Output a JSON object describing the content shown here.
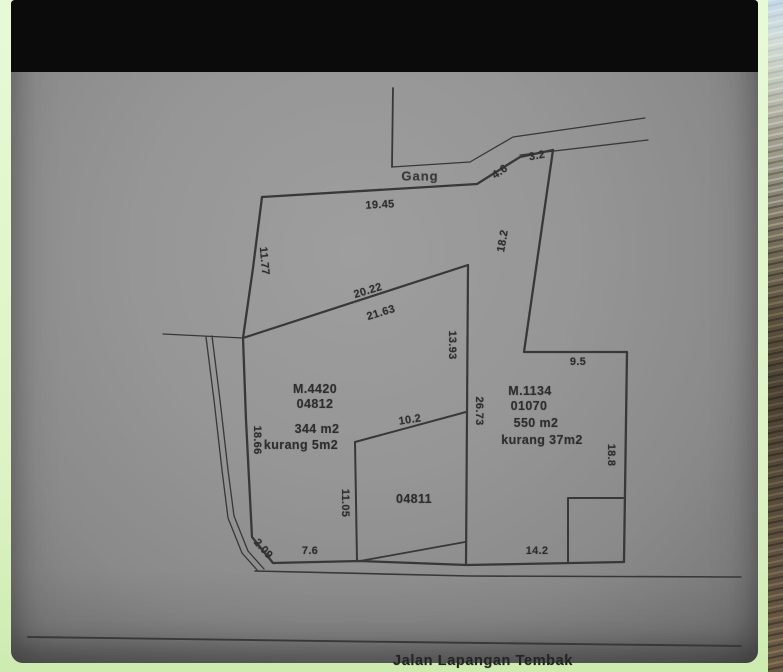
{
  "map": {
    "top_path_label": "Gang",
    "bottom_road_label": "Jalan Lapangan Tembak",
    "parcels": {
      "left": {
        "cert": "M.4420",
        "number": "04812",
        "area": "344 m2",
        "shortage": "kurang 5m2"
      },
      "right": {
        "cert": "M.1134",
        "number": "01070",
        "area": "550 m2",
        "shortage": "kurang 37m2"
      },
      "middle": {
        "number": "04811"
      }
    },
    "measurements": {
      "m19_45": "19.45",
      "m11_77": "11.77",
      "m4_6": "4.6",
      "m3_2": "3.2",
      "m18_2": "18.2",
      "m20_22": "20.22",
      "m21_63": "21.63",
      "m13_93": "13.93",
      "m26_73": "26.73",
      "m9_5": "9.5",
      "m10_2": "10.2",
      "m18_66": "18.66",
      "m11_05": "11.05",
      "m18_8": "18.8",
      "m2_09": "2.09",
      "m7_6": "7.6",
      "m14_2": "14.2"
    },
    "colors": {
      "border_green": "#ddf3c4",
      "photo_gray": "#969696",
      "ink": "#3a3a3a",
      "topbar_black": "#0b0b0b"
    }
  }
}
